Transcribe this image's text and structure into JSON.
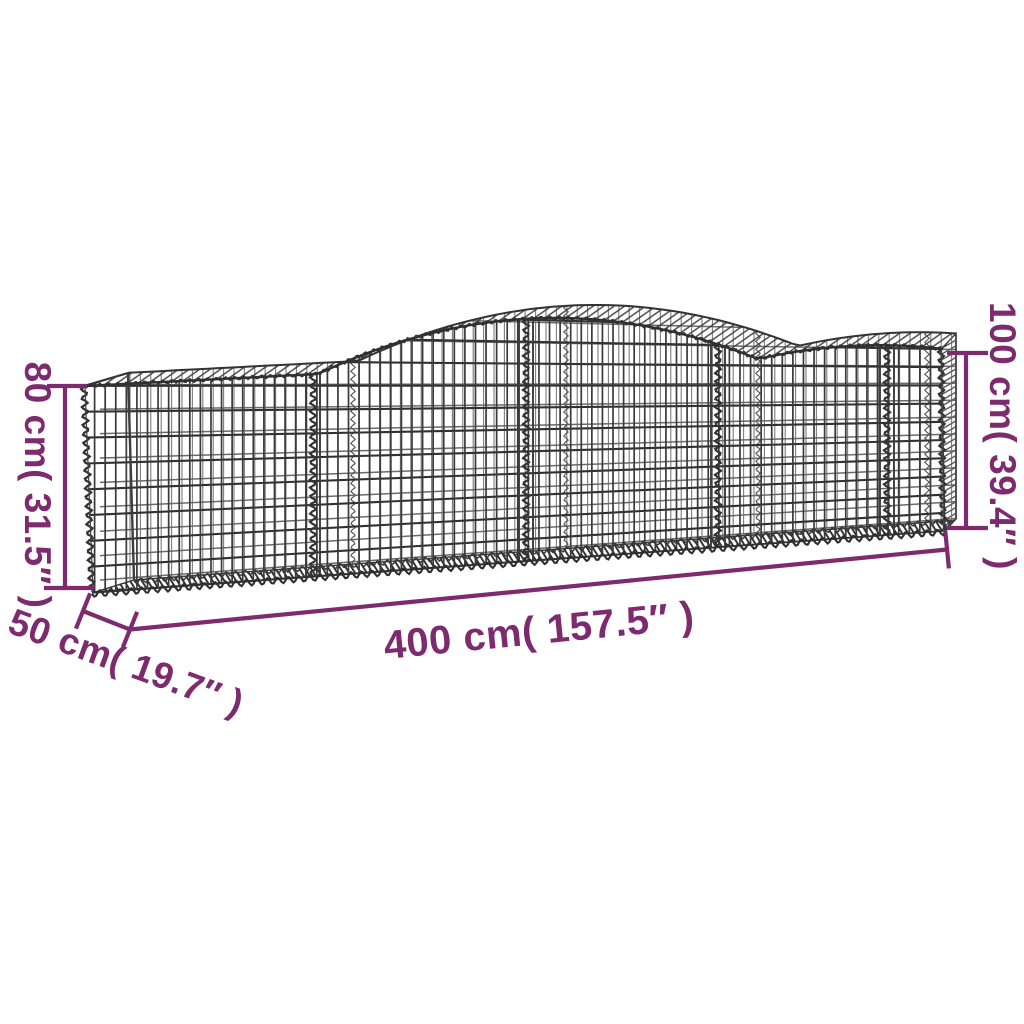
{
  "diagram": {
    "background": "#ffffff",
    "accent_color": "#7d2a6f",
    "wire_color": "#3a3a3a",
    "wire_color_light": "#5a5a5a"
  },
  "dimensions": {
    "height_left": "80 cm( 31.5″ )",
    "height_right": "100 cm( 39.4″ )",
    "length": "400 cm( 157.5″ )",
    "depth": "50 cm( 19.7″ )"
  }
}
